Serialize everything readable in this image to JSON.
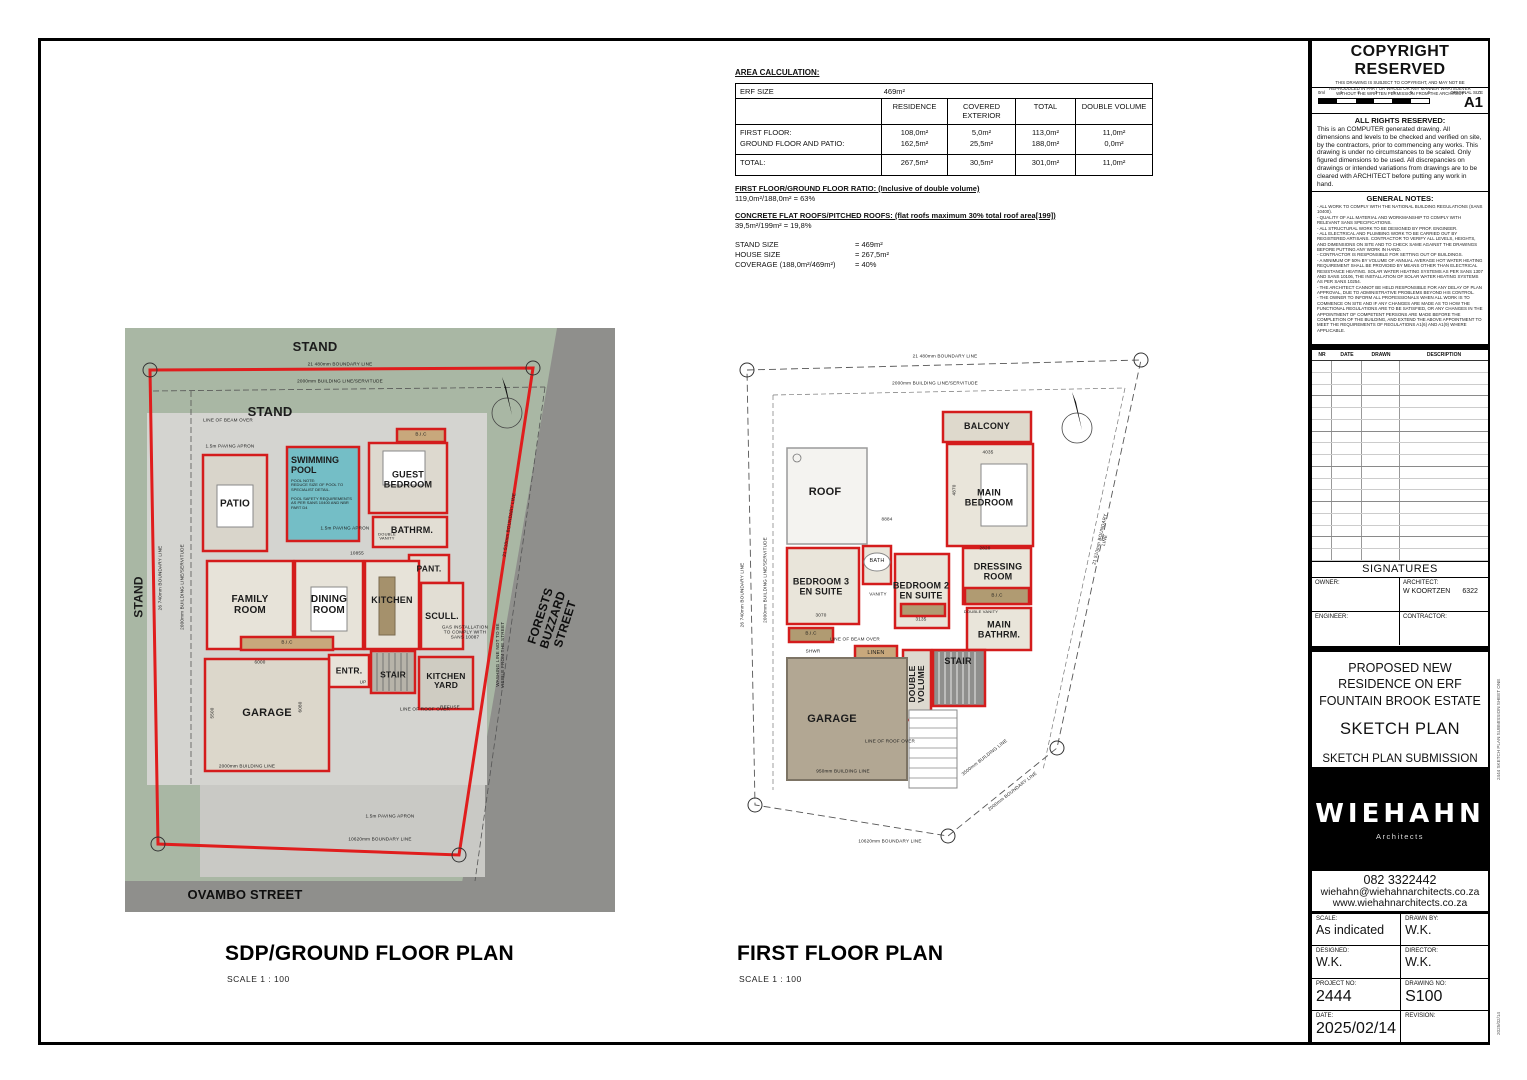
{
  "palette": {
    "wall_red": "#d41c1c",
    "site_green": "#a9b7a4",
    "road_gray": "#8f8f8c",
    "paving_gray": "#d4d4d0",
    "pool_blue": "#74bec6",
    "floor_beige": "#e7e3d9",
    "cabinet_tan": "#c8a87c",
    "roof_brown": "#b2a793",
    "stair_gray": "#8f8f8d"
  },
  "area_calc": {
    "title": "AREA CALCULATION:",
    "erf_label": "ERF SIZE",
    "erf_value": "469m²",
    "columns": [
      "RESIDENCE",
      "COVERED EXTERIOR",
      "TOTAL",
      "DOUBLE VOLUME"
    ],
    "rows": [
      {
        "label": "FIRST FLOOR:",
        "values": [
          "108,0m²",
          "5,0m²",
          "113,0m²",
          "11,0m²"
        ]
      },
      {
        "label": "GROUND FLOOR AND PATIO:",
        "values": [
          "162,5m²",
          "25,5m²",
          "188,0m²",
          "0,0m²"
        ]
      },
      {
        "label": "TOTAL:",
        "values": [
          "267,5m²",
          "30,5m²",
          "301,0m²",
          "11,0m²"
        ]
      }
    ],
    "ratio_heading": "FIRST FLOOR/GROUND FLOOR RATIO: (Inclusive of double volume)",
    "ratio_value": "119,0m²/188,0m² = 63%",
    "roofs_heading": "CONCRETE FLAT ROOFS/PITCHED ROOFS: (flat roofs maximum 30% total roof area[199])",
    "roofs_value": "39,5m²/199m² = 19,8%",
    "stand_size_label": "STAND SIZE",
    "stand_size_value": "= 469m²",
    "house_size_label": "HOUSE SIZE",
    "house_size_value": "= 267,5m²",
    "coverage_label": "COVERAGE (188,0m²/469m²)",
    "coverage_value": "= 40%"
  },
  "ground_plan": {
    "title": "SDP/GROUND FLOOR PLAN",
    "scale": "SCALE  1 : 100",
    "labels": {
      "stand_top": "STAND",
      "stand_inner": "STAND",
      "stand_left": "STAND",
      "ovambo": "OVAMBO STREET",
      "forests": "FORESTS BUZZARD STREET",
      "boundary_top": "21 480mm BOUNDARY LINE",
      "building_line_top": "2000mm BUILDING LINE/SERVITUDE",
      "boundary_left": "26 740mm BOUNDARY LINE",
      "building_line_left": "2000mm BUILDING LINE/SERVITUDE",
      "boundary_right": "21 510mm BOUNDARY LINE",
      "boundary_bottom": "10620mm BOUNDARY LINE",
      "building_line_bottom": "2000mm BUILDING LINE",
      "paving_top": "1.5m PAVING APRON",
      "paving_mid": "1.5m PAVING APRON",
      "paving_bottom": "1.5m PAVING APRON",
      "line_of_beam": "LINE OF BEAM OVER",
      "line_of_roof": "LINE OF ROOF OVER",
      "patio": "PATIO",
      "pool": "SWIMMING\nPOOL",
      "pool_note": "POOL NOTE:\nREDUCE SIZE OF POOL TO\nSPECIALIST DETAIL.\n\nPOOL SAFETY REQUIREMENTS\nAS PER SANS 10400 AND NBR\nPART D4",
      "guest_bedroom": "GUEST\nBEDROOM",
      "bathrm": "BATHRM.",
      "double_vanity": "DOUBLE\nVANITY",
      "pant": "PANT.",
      "family_room": "FAMILY\nROOM",
      "dining_room": "DINING\nROOM",
      "kitchen": "KITCHEN",
      "scull": "SCULL.",
      "garage": "GARAGE",
      "entr": "ENTR.",
      "up": "UP",
      "stair": "STAIR",
      "kitchen_yard": "KITCHEN\nYARD",
      "refuse": "REFUSE",
      "bic": "B.I.C",
      "bic2": "B.I.C",
      "gas_note": "GAS INSTALLATION\nTO COMPLY WITH\nSANS 10087",
      "washing_note": "WASHING LINE NOT TO BE\nVISIBLE FROM THE STREET",
      "dim_10855": "10855",
      "dim_6000": "6000",
      "dim_5500": "5500",
      "dim_6080": "6080"
    }
  },
  "first_plan": {
    "title": "FIRST FLOOR PLAN",
    "scale": "SCALE  1 : 100",
    "labels": {
      "boundary_top": "21 480mm BOUNDARY LINE",
      "building_line_top": "2000mm BUILDING LINE/SERVITUDE",
      "boundary_left": "26 740mm BOUNDARY LINE",
      "building_line_left": "2000mm BUILDING LINE/SERVITUDE",
      "boundary_right": "21 510mm BOUNDARY LINE",
      "boundary_bottom": "10620mm BOUNDARY LINE",
      "boundary_bottom_diag": "2000mm BOUNDARY LINE",
      "building_line_right": "3500mm BUILDING LINE",
      "building_line_garage": "950mm BUILDING LINE",
      "balcony": "BALCONY",
      "roof": "ROOF",
      "main_bedroom": "MAIN\nBEDROOM",
      "dressing_room": "DRESSING\nROOM",
      "bedroom3": "BEDROOM 3\nEN SUITE",
      "bedroom2": "BEDROOM 2\nEN SUITE",
      "main_bathrm": "MAIN\nBATHRM.",
      "bath": "BATH",
      "linen": "LINEN",
      "double_volume": "DOUBLE\nVOLUME",
      "stair": "STAIR",
      "garage": "GARAGE",
      "bic": "B.I.C",
      "bic2": "B.I.C",
      "shwr": "SHWR",
      "vanity": "VANITY",
      "double_vanity": "DOUBLE VANITY",
      "line_of_beam": "LINE OF BEAM OVER",
      "line_of_roof": "LINE OF ROOF OVER",
      "dim_4035": "4035",
      "dim_4870": "4870",
      "dim_8884": "8884",
      "dim_3070": "3070",
      "dim_3135": "3135",
      "dim_2820": "2820"
    }
  },
  "title_block": {
    "copyright": {
      "title": "COPYRIGHT RESERVED",
      "subtext": "THIS DRAWING IS SUBJECT TO COPYRIGHT, AND MAY NOT BE REPRODUCED IN PART OR WHOLE OR ANY MANNER WHATSOEVER WITHOUT THE WRITTEN PERMISSION FROM THE ARCHITECT",
      "scale_ticks": [
        "0ml",
        "1",
        "2",
        "3",
        "4",
        "5",
        "6"
      ],
      "original_size_label": "ORIGINAL SIZE",
      "original_size": "A1"
    },
    "rights": {
      "heading": "ALL RIGHTS RESERVED:",
      "body": "This is an COMPUTER generated drawing. All dimensions and levels to be checked and verified on site, by the contractors, prior to commencing any works. This drawing is under no circumstances to be scaled. Only figured dimensions to be used. All discrepancies on drawings or intended variations from drawings are to be cleared with ARCHITECT before putting any work in hand."
    },
    "general_notes": {
      "heading": "GENERAL NOTES:",
      "body": "- ALL WORK TO COMPLY WITH THE NATIONAL BUILDING REGULATIONS (SANS 10400).\n- QUALITY OF ALL MATERIAL AND WORKMANSHIP TO COMPLY WITH RELEVANT SANS SPECIFICATIONS.\n- ALL STRUCTURAL WORK TO BE DESIGNED BY PROF. ENGINEER.\n- ALL ELECTRICAL AND PLUMBING WORK TO BE CARRIED OUT BY REGISTERED ARTISANS. CONTRACTOR TO VERIFY ALL LEVELS, HEIGHTS, AND DIMENSIONS ON SITE AND TO CHECK SAME AGAINST THE DRAWINGS BEFORE PUTTING ANY WORK IN HAND.\n- CONTRACTOR IS RESPONSIBLE FOR SETTING OUT OF BUILDINGS.\n- A MINIMUM OF 50% BY VOLUME OF ANNUAL AVERAGE HOT WATER HEATING REQUIREMENT SHALL BE PROVIDED BY MEANS OTHER THAN ELECTRICAL RESISTANCE HEATING. SOLAR WATER HEATING SYSTEMS AS PER SANS 1307 AND SANS 10106, THE INSTALLATION OF SOLAR WATER HEATING SYSTEMS AS PER SANS 10254.\n- THE ARCHITECT CANNOT BE HELD RESPONSIBLE FOR ANY DELAY OF PLAN APPROVAL, DUE TO ADMINISTRATIVE PROBLEMS BEYOND HIS CONTROL.\n- THE OWNER TO INFORM ALL PROFESSIONALS WHEN ALL WORK IS TO COMMENCE ON SITE AND IF ANY CHANGES ARE MADE AS TO HOW THE FUNCTIONAL REGULATIONS ARE TO BE SATISFIED, OR ANY CHANGES IN THE APPOINTMENT OF COMPETENT PERSONS ARE MADE BEFORE THE COMPLETION OF THE BUILDING, AND EXTEND THE ABOVE APPOINTMENT TO MEET THE REQUIREMENTS OF REGULATIONS A1(6) AND A1(9) WHERE APPLICABLE."
    },
    "revisions": {
      "headers": [
        "NR",
        "DATE",
        "DRAWN",
        "DESCRIPTION"
      ]
    },
    "signatures": {
      "heading": "SIGNATURES",
      "owner_label": "OWNER:",
      "architect_label": "ARCHITECT:",
      "architect_value": "W KOORTZEN",
      "architect_number": "6322",
      "engineer_label": "ENGINEER:",
      "contractor_label": "CONTRACTOR:"
    },
    "project": {
      "title_line1": "PROPOSED NEW",
      "title_line2": "RESIDENCE ON ERF",
      "title_line3": "FOUNTAIN BROOK ESTATE",
      "doc_type": "SKETCH PLAN",
      "submission_line1": "SKETCH PLAN SUBMISSION",
      "submission_line2": "SHEET ONE"
    },
    "firm": {
      "logo": "WIEHAHN",
      "tagline": "Architects",
      "phone": "082 3322442",
      "email": "wiehahn@wiehahnarchitects.co.za",
      "website": "www.wiehahnarchitects.co.za"
    },
    "fields": {
      "scale_label": "SCALE:",
      "scale": "As indicated",
      "drawn_label": "DRAWN BY:",
      "drawn": "W.K.",
      "designed_label": "DESIGNED:",
      "designed": "W.K.",
      "director_label": "DIRECTOR:",
      "director": "W.K.",
      "project_no_label": "PROJECT NO:",
      "project_no": "2444",
      "drawing_no_label": "DRAWING NO:",
      "drawing_no": "S100",
      "date_label": "DATE:",
      "date": "2025/02/14",
      "revision_label": "REVISION:",
      "revision": ""
    }
  },
  "edge_note": "2444 SKETCH PLAN SUBMISSION SHEET ONE"
}
